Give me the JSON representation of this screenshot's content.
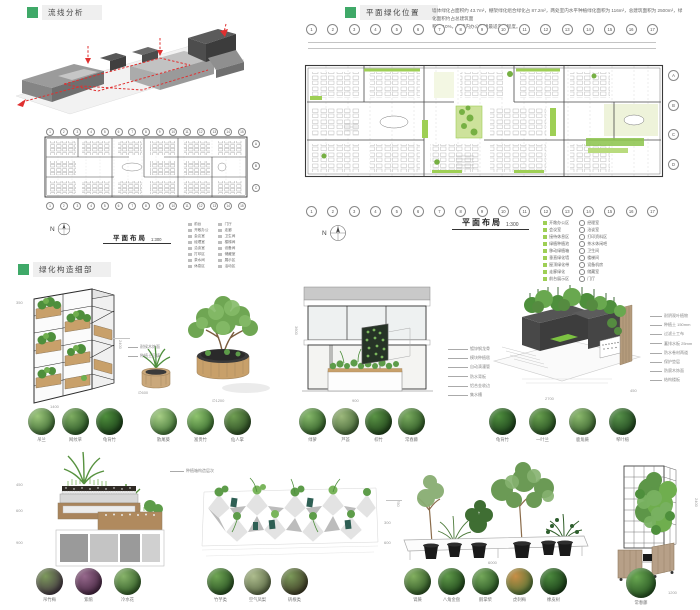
{
  "colors": {
    "accent": "#3fa968",
    "plan_green": "#9ecf55",
    "circulation_red": "#e03030"
  },
  "headers": {
    "circulation": "流线分析",
    "greening": "平面绿化位置",
    "detail": "绿化构造细部"
  },
  "note": {
    "l1": "墙体绿化占面积约 43.7m²，棚架绿化组合绿化占 87.2m²，两处室内水平种植绿化面积为 116m²，总建筑面积为 2500m²，绿化面积约占总建筑面",
    "l2": "积的 10%，是室内办公环境最适宜的程度。"
  },
  "plan_colored": {
    "caption": "平面布局",
    "scale": "1:300",
    "north": "N",
    "grid": [
      "1",
      "2",
      "3",
      "4",
      "5",
      "6",
      "7",
      "8",
      "9",
      "10",
      "11",
      "12",
      "13",
      "14",
      "15",
      "16",
      "17"
    ],
    "rows": [
      "A",
      "B",
      "C",
      "D"
    ],
    "legend1": [
      "开敞办公区",
      "会议室",
      "接待休息区",
      "绿植种植池",
      "移动绿植箱",
      "垂直绿化墙",
      "屋顶绿化带",
      "走廊绿化",
      "前台展示区"
    ],
    "legend2": [
      "经理室",
      "洽谈室",
      "打印资料区",
      "茶水休闲吧",
      "卫生间",
      "楼梯间",
      "设备机房",
      "储藏室",
      "门厅"
    ]
  },
  "plan_bw": {
    "caption": "平面布局",
    "scale": "1:300",
    "north": "N",
    "grid": [
      "1",
      "2",
      "3",
      "4",
      "5",
      "6",
      "7",
      "8",
      "9",
      "10",
      "11",
      "12",
      "13",
      "14",
      "15"
    ],
    "rows": [
      "A",
      "B",
      "C"
    ],
    "legend1": [
      "前台",
      "开敞办公",
      "会议室",
      "经理室",
      "洽谈室",
      "打印区",
      "茶水间",
      "休息区"
    ],
    "legend2": [
      "门厅",
      "走廊",
      "卫生间",
      "楼梯间",
      "设备间",
      "储藏室",
      "展示区",
      "活动区"
    ]
  },
  "details": {
    "shelf": {
      "dims": [
        "350",
        "1400",
        "2400"
      ]
    },
    "pots": {
      "dims": [
        "∅600",
        "∅1200"
      ],
      "callouts": [
        "耐候木饰面",
        "种植土回填"
      ]
    },
    "facade": {
      "dims": [
        "3600",
        "900"
      ],
      "callouts": [
        "镀锌钢龙骨",
        "模块种植毯",
        "自动滴灌管",
        "防水背板",
        "铝合金收边",
        "集水槽"
      ]
    },
    "roof": {
      "dims": [
        "2700",
        "450"
      ],
      "callouts": [
        "耐阴观叶植物",
        "种植土 150mm",
        "过滤土工布",
        "蓄排水板 25mm",
        "防水卷材两道",
        "保护垫层",
        "防腐木饰面",
        "结构楼板"
      ]
    },
    "stepped": {
      "dims": [
        "450",
        "600",
        "900"
      ],
      "note": "种植箱构造层次"
    },
    "faceted": {
      "dims": [
        "300",
        "600"
      ]
    },
    "platform": {
      "dims": [
        "750",
        "6000"
      ]
    },
    "trellis": {
      "dims": [
        "2400",
        "1200"
      ]
    }
  },
  "plants": {
    "r1g1": [
      {
        "t": "吊兰",
        "c1": "#9cc77a",
        "c2": "#2f5a28"
      },
      {
        "t": "网纹草",
        "c1": "#7fae62",
        "c2": "#1f4a1e"
      },
      {
        "t": "龟背竹",
        "c1": "#4e8f3c",
        "c2": "#143414"
      }
    ],
    "r1g2": [
      {
        "t": "散尾葵",
        "c1": "#a8cf86",
        "c2": "#35682c"
      },
      {
        "t": "富贵竹",
        "c1": "#8fc46e",
        "c2": "#2c5e25"
      },
      {
        "t": "仙人掌",
        "c1": "#6f9e52",
        "c2": "#23411d"
      }
    ],
    "r1g3": [
      {
        "t": "绿萝",
        "c1": "#86b96a",
        "c2": "#26511f"
      },
      {
        "t": "芦荟",
        "c1": "#9db97c",
        "c2": "#3a5c2e"
      },
      {
        "t": "棕竹",
        "c1": "#5a9445",
        "c2": "#1a3a16"
      },
      {
        "t": "常春藤",
        "c1": "#79ab5e",
        "c2": "#224a1c"
      }
    ],
    "r1g4": [
      {
        "t": "龟背竹",
        "c1": "#4f8f3e",
        "c2": "#153516"
      },
      {
        "t": "一叶兰",
        "c1": "#68a04e",
        "c2": "#1d421a"
      },
      {
        "t": "鹿角蕨",
        "c1": "#8cba6d",
        "c2": "#2e5526"
      },
      {
        "t": "琴叶榕",
        "c1": "#57924a",
        "c2": "#183a18"
      }
    ],
    "r2g1": [
      {
        "t": "吊竹梅",
        "c1": "#7d9a5c",
        "c2": "#3c2b3e"
      },
      {
        "t": "紫鹃",
        "c1": "#96688c",
        "c2": "#3c1f38"
      },
      {
        "t": "冷水花",
        "c1": "#88b46a",
        "c2": "#27511f"
      }
    ],
    "r2g2": [
      {
        "t": "竹芋类",
        "c1": "#6fa653",
        "c2": "#1e421b"
      },
      {
        "t": "空气凤梨",
        "c1": "#aebd8e",
        "c2": "#4e5c3a"
      },
      {
        "t": "矾根类",
        "c1": "#7c9a5a",
        "c2": "#36301f"
      }
    ],
    "r2g3": [
      {
        "t": "肾蕨",
        "c1": "#83b060",
        "c2": "#23491d"
      },
      {
        "t": "八角金盘",
        "c1": "#5f9a49",
        "c2": "#173a15"
      },
      {
        "t": "鹅掌柴",
        "c1": "#74a85a",
        "c2": "#1f4a1c"
      },
      {
        "t": "虎刺梅",
        "c1": "#c98f46",
        "c2": "#3f6e33"
      },
      {
        "t": "橡皮树",
        "c1": "#4c8a3e",
        "c2": "#123112"
      }
    ],
    "r2g4": [
      {
        "t": "常春藤",
        "c1": "#69a851",
        "c2": "#1c451a"
      }
    ]
  }
}
